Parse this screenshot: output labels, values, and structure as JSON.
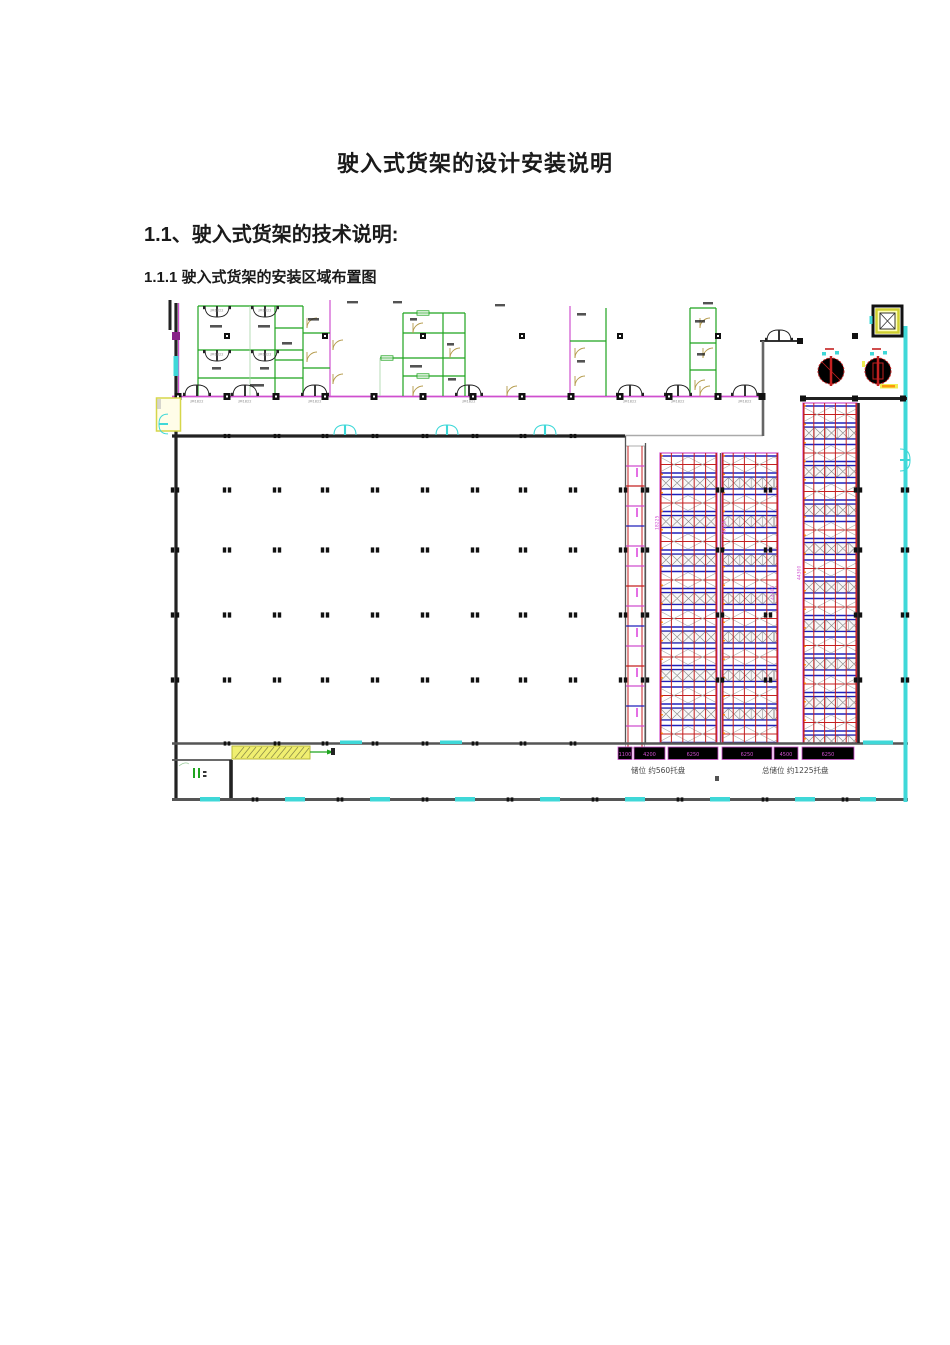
{
  "document": {
    "title": "驶入式货架的设计安装说明",
    "section_heading": "1.1、驶入式货架的技术说明:",
    "subsection_heading": "1.1.1  驶入式货架的安装区域布置图"
  },
  "drawing": {
    "door_label": "JM1822",
    "dim_labels": [
      "1100",
      "4200",
      "6250",
      "6250",
      "4500",
      "6250"
    ],
    "vertical_dims": [
      "18225",
      "18225",
      "44300",
      "44300"
    ],
    "capacity_left": "储位 约560托盘",
    "capacity_right": "总储位 约1225托盘",
    "colors": {
      "wall": "#222222",
      "grn": "#1fa41f",
      "mag": "#cf4fcf",
      "cyn": "#3fd8d8",
      "red": "#c42121",
      "blu": "#2020bb",
      "tan": "#b49a4a",
      "yel": "#efef52",
      "org": "#ff8a00"
    }
  }
}
